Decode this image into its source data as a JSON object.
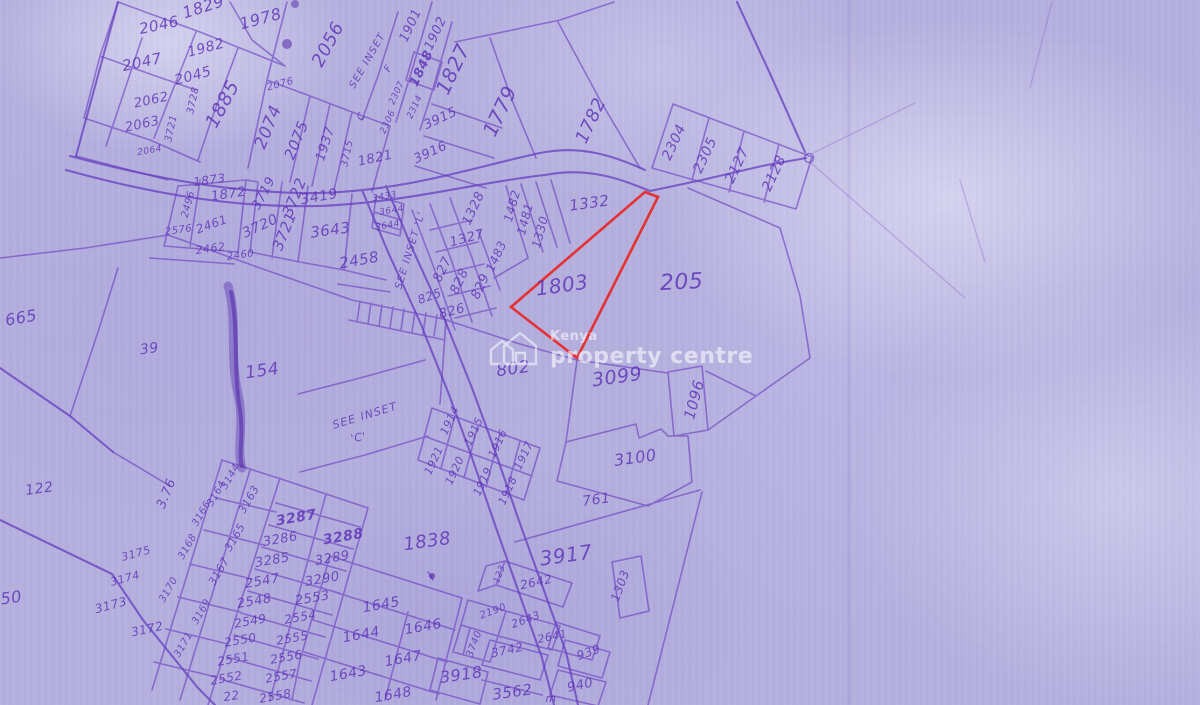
{
  "watermark": {
    "brand_top": "Kenya",
    "brand_bottom": "property centre",
    "logo": "house-icon"
  },
  "map": {
    "type": "cadastral-survey-sheet",
    "highlighted_plot": "1803",
    "colors": {
      "background": "#b4afdd",
      "ink": "#5b30b5",
      "line": "#6a3fc0",
      "highlight": "#e82a2a",
      "watermark": "#ffffff"
    },
    "red_polygon_points": [
      [
        645,
        192
      ],
      [
        658,
        197
      ],
      [
        577,
        358
      ],
      [
        511,
        307
      ]
    ],
    "inset_references": [
      "SEE INSET F",
      "SEE INSET 'L'",
      "SEE INSET 'C'"
    ],
    "labels": [
      {
        "t": "1829",
        "x": 205,
        "y": 12,
        "r": -18,
        "s": 16
      },
      {
        "t": "1978",
        "x": 262,
        "y": 24,
        "r": -15,
        "s": 16
      },
      {
        "t": "2046",
        "x": 160,
        "y": 30,
        "r": -12,
        "s": 15
      },
      {
        "t": "1982",
        "x": 207,
        "y": 52,
        "r": -15,
        "s": 14
      },
      {
        "t": "2047",
        "x": 143,
        "y": 67,
        "r": -12,
        "s": 15
      },
      {
        "t": "2045",
        "x": 194,
        "y": 80,
        "r": -15,
        "s": 14
      },
      {
        "t": "1885",
        "x": 228,
        "y": 107,
        "r": -62,
        "s": 19
      },
      {
        "t": "2076",
        "x": 281,
        "y": 87,
        "r": -15,
        "s": 10
      },
      {
        "t": "2056",
        "x": 333,
        "y": 47,
        "r": -62,
        "s": 18
      },
      {
        "t": "2062",
        "x": 152,
        "y": 104,
        "r": -12,
        "s": 13
      },
      {
        "t": "2063",
        "x": 143,
        "y": 128,
        "r": -12,
        "s": 13
      },
      {
        "t": "3728",
        "x": 196,
        "y": 101,
        "r": -78,
        "s": 10
      },
      {
        "t": "3721",
        "x": 174,
        "y": 129,
        "r": -78,
        "s": 10
      },
      {
        "t": "2064",
        "x": 150,
        "y": 153,
        "r": -10,
        "s": 9
      },
      {
        "t": "2074",
        "x": 273,
        "y": 129,
        "r": -68,
        "s": 17
      },
      {
        "t": "2075",
        "x": 301,
        "y": 142,
        "r": -68,
        "s": 15
      },
      {
        "t": "1937",
        "x": 329,
        "y": 145,
        "r": -72,
        "s": 13
      },
      {
        "t": "3715",
        "x": 350,
        "y": 154,
        "r": -78,
        "s": 10
      },
      {
        "t": "1821",
        "x": 376,
        "y": 162,
        "r": -12,
        "s": 13
      },
      {
        "t": "SEE INSET",
        "x": 370,
        "y": 62,
        "r": -60,
        "s": 10,
        "c": "inset-label"
      },
      {
        "t": "F",
        "x": 391,
        "y": 70,
        "r": -60,
        "s": 10
      },
      {
        "t": "C",
        "x": 364,
        "y": 118,
        "r": -60,
        "s": 10
      },
      {
        "t": "1901",
        "x": 414,
        "y": 27,
        "r": -65,
        "s": 13
      },
      {
        "t": "1902",
        "x": 439,
        "y": 35,
        "r": -65,
        "s": 13
      },
      {
        "t": "1848",
        "x": 425,
        "y": 70,
        "r": -65,
        "s": 13,
        "w": 700
      },
      {
        "t": "2307",
        "x": 399,
        "y": 94,
        "r": -65,
        "s": 9
      },
      {
        "t": "2314",
        "x": 417,
        "y": 108,
        "r": -65,
        "s": 9
      },
      {
        "t": "2306",
        "x": 390,
        "y": 123,
        "r": -65,
        "s": 9
      },
      {
        "t": "1827",
        "x": 459,
        "y": 72,
        "r": -65,
        "s": 20
      },
      {
        "t": "3915",
        "x": 442,
        "y": 122,
        "r": -25,
        "s": 13
      },
      {
        "t": "3916",
        "x": 432,
        "y": 156,
        "r": -25,
        "s": 13
      },
      {
        "t": "1779",
        "x": 506,
        "y": 114,
        "r": -65,
        "s": 20
      },
      {
        "t": "1782",
        "x": 596,
        "y": 123,
        "r": -65,
        "s": 18
      },
      {
        "t": "2304",
        "x": 678,
        "y": 144,
        "r": -65,
        "s": 14
      },
      {
        "t": "2305",
        "x": 709,
        "y": 157,
        "r": -65,
        "s": 14
      },
      {
        "t": "2127",
        "x": 741,
        "y": 167,
        "r": -65,
        "s": 14
      },
      {
        "t": "2128",
        "x": 778,
        "y": 175,
        "r": -65,
        "s": 14
      },
      {
        "t": "1873",
        "x": 210,
        "y": 184,
        "r": -8,
        "s": 12
      },
      {
        "t": "1872",
        "x": 229,
        "y": 198,
        "r": -8,
        "s": 13
      },
      {
        "t": "2496",
        "x": 191,
        "y": 205,
        "r": -75,
        "s": 10
      },
      {
        "t": "2461",
        "x": 213,
        "y": 228,
        "r": -20,
        "s": 12
      },
      {
        "t": "2576",
        "x": 179,
        "y": 233,
        "r": -8,
        "s": 10
      },
      {
        "t": "2462",
        "x": 211,
        "y": 252,
        "r": -8,
        "s": 11
      },
      {
        "t": "2460",
        "x": 241,
        "y": 258,
        "r": -8,
        "s": 10
      },
      {
        "t": "3719",
        "x": 267,
        "y": 195,
        "r": -62,
        "s": 13
      },
      {
        "t": "3720",
        "x": 262,
        "y": 230,
        "r": -25,
        "s": 14
      },
      {
        "t": "3721",
        "x": 289,
        "y": 233,
        "r": -68,
        "s": 15
      },
      {
        "t": "3722",
        "x": 299,
        "y": 199,
        "r": -68,
        "s": 15
      },
      {
        "t": "3419",
        "x": 320,
        "y": 201,
        "r": -10,
        "s": 14
      },
      {
        "t": "3643",
        "x": 331,
        "y": 235,
        "r": -8,
        "s": 15
      },
      {
        "t": "2458",
        "x": 360,
        "y": 265,
        "r": -10,
        "s": 15
      },
      {
        "t": "3433",
        "x": 385,
        "y": 199,
        "r": -10,
        "s": 9
      },
      {
        "t": "3644",
        "x": 392,
        "y": 213,
        "r": -10,
        "s": 9
      },
      {
        "t": "3644",
        "x": 388,
        "y": 228,
        "r": -10,
        "s": 9
      },
      {
        "t": "SEE INSET 'L'",
        "x": 413,
        "y": 251,
        "r": -73,
        "s": 10,
        "c": "inset-label"
      },
      {
        "t": "1328",
        "x": 477,
        "y": 210,
        "r": -65,
        "s": 13
      },
      {
        "t": "1482",
        "x": 516,
        "y": 207,
        "r": -75,
        "s": 12
      },
      {
        "t": "1481",
        "x": 529,
        "y": 220,
        "r": -75,
        "s": 12
      },
      {
        "t": "1330",
        "x": 544,
        "y": 233,
        "r": -75,
        "s": 12
      },
      {
        "t": "1327",
        "x": 468,
        "y": 242,
        "r": -15,
        "s": 13
      },
      {
        "t": "1483",
        "x": 500,
        "y": 258,
        "r": -65,
        "s": 12
      },
      {
        "t": "827",
        "x": 446,
        "y": 271,
        "r": -65,
        "s": 13
      },
      {
        "t": "828",
        "x": 463,
        "y": 283,
        "r": -65,
        "s": 13
      },
      {
        "t": "829",
        "x": 484,
        "y": 288,
        "r": -65,
        "s": 13
      },
      {
        "t": "825",
        "x": 431,
        "y": 300,
        "r": -20,
        "s": 12
      },
      {
        "t": "826",
        "x": 453,
        "y": 315,
        "r": -15,
        "s": 13
      },
      {
        "t": "1332",
        "x": 590,
        "y": 208,
        "r": -8,
        "s": 15
      },
      {
        "t": "1803",
        "x": 563,
        "y": 292,
        "r": -8,
        "s": 20
      },
      {
        "t": "205",
        "x": 682,
        "y": 289,
        "r": -3,
        "s": 22
      },
      {
        "t": "3099",
        "x": 618,
        "y": 383,
        "r": -8,
        "s": 19
      },
      {
        "t": "802",
        "x": 514,
        "y": 374,
        "r": -8,
        "s": 17
      },
      {
        "t": "1096",
        "x": 699,
        "y": 401,
        "r": -75,
        "s": 15
      },
      {
        "t": "3100",
        "x": 636,
        "y": 463,
        "r": -8,
        "s": 16
      },
      {
        "t": "761",
        "x": 597,
        "y": 504,
        "r": -8,
        "s": 14
      },
      {
        "t": "1914",
        "x": 453,
        "y": 422,
        "r": -65,
        "s": 11
      },
      {
        "t": "1915",
        "x": 477,
        "y": 433,
        "r": -65,
        "s": 11
      },
      {
        "t": "1916",
        "x": 501,
        "y": 445,
        "r": -65,
        "s": 11
      },
      {
        "t": "1917",
        "x": 527,
        "y": 457,
        "r": -65,
        "s": 11
      },
      {
        "t": "1921",
        "x": 437,
        "y": 462,
        "r": -65,
        "s": 11
      },
      {
        "t": "1920",
        "x": 458,
        "y": 472,
        "r": -65,
        "s": 11
      },
      {
        "t": "1919",
        "x": 486,
        "y": 483,
        "r": -65,
        "s": 11
      },
      {
        "t": "1918",
        "x": 511,
        "y": 492,
        "r": -65,
        "s": 11
      },
      {
        "t": "SEE INSET",
        "x": 366,
        "y": 419,
        "r": -17,
        "s": 11,
        "c": "inset-label"
      },
      {
        "t": "'C'",
        "x": 359,
        "y": 441,
        "r": -10,
        "s": 11
      },
      {
        "t": "665",
        "x": 22,
        "y": 323,
        "r": -10,
        "s": 16
      },
      {
        "t": "39",
        "x": 150,
        "y": 353,
        "r": -8,
        "s": 14
      },
      {
        "t": "154",
        "x": 263,
        "y": 376,
        "r": -8,
        "s": 17
      },
      {
        "t": "122",
        "x": 40,
        "y": 493,
        "r": -8,
        "s": 14
      },
      {
        "t": "50",
        "x": 12,
        "y": 603,
        "r": -8,
        "s": 16
      },
      {
        "t": "3.76",
        "x": 170,
        "y": 495,
        "r": -68,
        "s": 13
      },
      {
        "t": "3144",
        "x": 233,
        "y": 478,
        "r": -60,
        "s": 10
      },
      {
        "t": "3164",
        "x": 219,
        "y": 495,
        "r": -60,
        "s": 10
      },
      {
        "t": "3166",
        "x": 204,
        "y": 515,
        "r": -60,
        "s": 10
      },
      {
        "t": "3168",
        "x": 190,
        "y": 548,
        "r": -60,
        "s": 10
      },
      {
        "t": "3170",
        "x": 171,
        "y": 591,
        "r": -60,
        "s": 10
      },
      {
        "t": "3163",
        "x": 252,
        "y": 501,
        "r": -60,
        "s": 11
      },
      {
        "t": "3165",
        "x": 238,
        "y": 539,
        "r": -60,
        "s": 11
      },
      {
        "t": "3167",
        "x": 222,
        "y": 573,
        "r": -60,
        "s": 11
      },
      {
        "t": "3169",
        "x": 204,
        "y": 613,
        "r": -60,
        "s": 10
      },
      {
        "t": "3171",
        "x": 186,
        "y": 646,
        "r": -60,
        "s": 10
      },
      {
        "t": "3175",
        "x": 137,
        "y": 557,
        "r": -15,
        "s": 11
      },
      {
        "t": "3174",
        "x": 126,
        "y": 582,
        "r": -15,
        "s": 11
      },
      {
        "t": "3173",
        "x": 112,
        "y": 609,
        "r": -15,
        "s": 12
      },
      {
        "t": "3172",
        "x": 148,
        "y": 633,
        "r": -12,
        "s": 12
      },
      {
        "t": "3287",
        "x": 297,
        "y": 522,
        "r": -10,
        "s": 14,
        "w": 700
      },
      {
        "t": "3286",
        "x": 281,
        "y": 543,
        "r": -10,
        "s": 13
      },
      {
        "t": "3285",
        "x": 273,
        "y": 564,
        "r": -10,
        "s": 13
      },
      {
        "t": "2547",
        "x": 263,
        "y": 585,
        "r": -10,
        "s": 13
      },
      {
        "t": "2548",
        "x": 255,
        "y": 605,
        "r": -10,
        "s": 13
      },
      {
        "t": "3288",
        "x": 344,
        "y": 541,
        "r": -10,
        "s": 14,
        "w": 700
      },
      {
        "t": "3289",
        "x": 333,
        "y": 562,
        "r": -10,
        "s": 13
      },
      {
        "t": "3290",
        "x": 323,
        "y": 583,
        "r": -10,
        "s": 13
      },
      {
        "t": "2553",
        "x": 313,
        "y": 602,
        "r": -10,
        "s": 13
      },
      {
        "t": "2549",
        "x": 251,
        "y": 625,
        "r": -10,
        "s": 12
      },
      {
        "t": "2554",
        "x": 301,
        "y": 621,
        "r": -10,
        "s": 12
      },
      {
        "t": "2550",
        "x": 241,
        "y": 644,
        "r": -10,
        "s": 12
      },
      {
        "t": "2555",
        "x": 293,
        "y": 642,
        "r": -10,
        "s": 12
      },
      {
        "t": "2551",
        "x": 234,
        "y": 663,
        "r": -10,
        "s": 12
      },
      {
        "t": "2556",
        "x": 287,
        "y": 661,
        "r": -10,
        "s": 12
      },
      {
        "t": "2552",
        "x": 227,
        "y": 682,
        "r": -10,
        "s": 12
      },
      {
        "t": "2557",
        "x": 282,
        "y": 680,
        "r": -10,
        "s": 12
      },
      {
        "t": "2558",
        "x": 276,
        "y": 700,
        "r": -10,
        "s": 12
      },
      {
        "t": "22",
        "x": 232,
        "y": 700,
        "r": -8,
        "s": 12
      },
      {
        "t": "1838",
        "x": 428,
        "y": 547,
        "r": -8,
        "s": 18
      },
      {
        "t": "1645",
        "x": 382,
        "y": 609,
        "r": -10,
        "s": 14
      },
      {
        "t": "1646",
        "x": 424,
        "y": 631,
        "r": -10,
        "s": 14
      },
      {
        "t": "1644",
        "x": 362,
        "y": 639,
        "r": -10,
        "s": 14
      },
      {
        "t": "1647",
        "x": 404,
        "y": 663,
        "r": -10,
        "s": 14
      },
      {
        "t": "1643",
        "x": 349,
        "y": 678,
        "r": -10,
        "s": 14
      },
      {
        "t": "1648",
        "x": 394,
        "y": 699,
        "r": -10,
        "s": 14
      },
      {
        "t": "3917",
        "x": 567,
        "y": 562,
        "r": -8,
        "s": 20
      },
      {
        "t": "1303",
        "x": 624,
        "y": 587,
        "r": -70,
        "s": 12
      },
      {
        "t": "2642",
        "x": 537,
        "y": 586,
        "r": -12,
        "s": 12
      },
      {
        "t": "123",
        "x": 502,
        "y": 575,
        "r": -70,
        "s": 9
      },
      {
        "t": "2190",
        "x": 494,
        "y": 614,
        "r": -20,
        "s": 10
      },
      {
        "t": "2643",
        "x": 527,
        "y": 623,
        "r": -20,
        "s": 11
      },
      {
        "t": "2641",
        "x": 553,
        "y": 640,
        "r": -12,
        "s": 11
      },
      {
        "t": "3740",
        "x": 477,
        "y": 645,
        "r": -70,
        "s": 10
      },
      {
        "t": "3742",
        "x": 508,
        "y": 654,
        "r": -12,
        "s": 12
      },
      {
        "t": "939",
        "x": 590,
        "y": 656,
        "r": -20,
        "s": 12
      },
      {
        "t": "940",
        "x": 581,
        "y": 689,
        "r": -12,
        "s": 13
      },
      {
        "t": "3918",
        "x": 462,
        "y": 680,
        "r": -8,
        "s": 16
      },
      {
        "t": "3562",
        "x": 513,
        "y": 697,
        "r": -8,
        "s": 15
      },
      {
        "t": "m",
        "x": 551,
        "y": 702,
        "r": 0,
        "s": 11
      }
    ]
  }
}
